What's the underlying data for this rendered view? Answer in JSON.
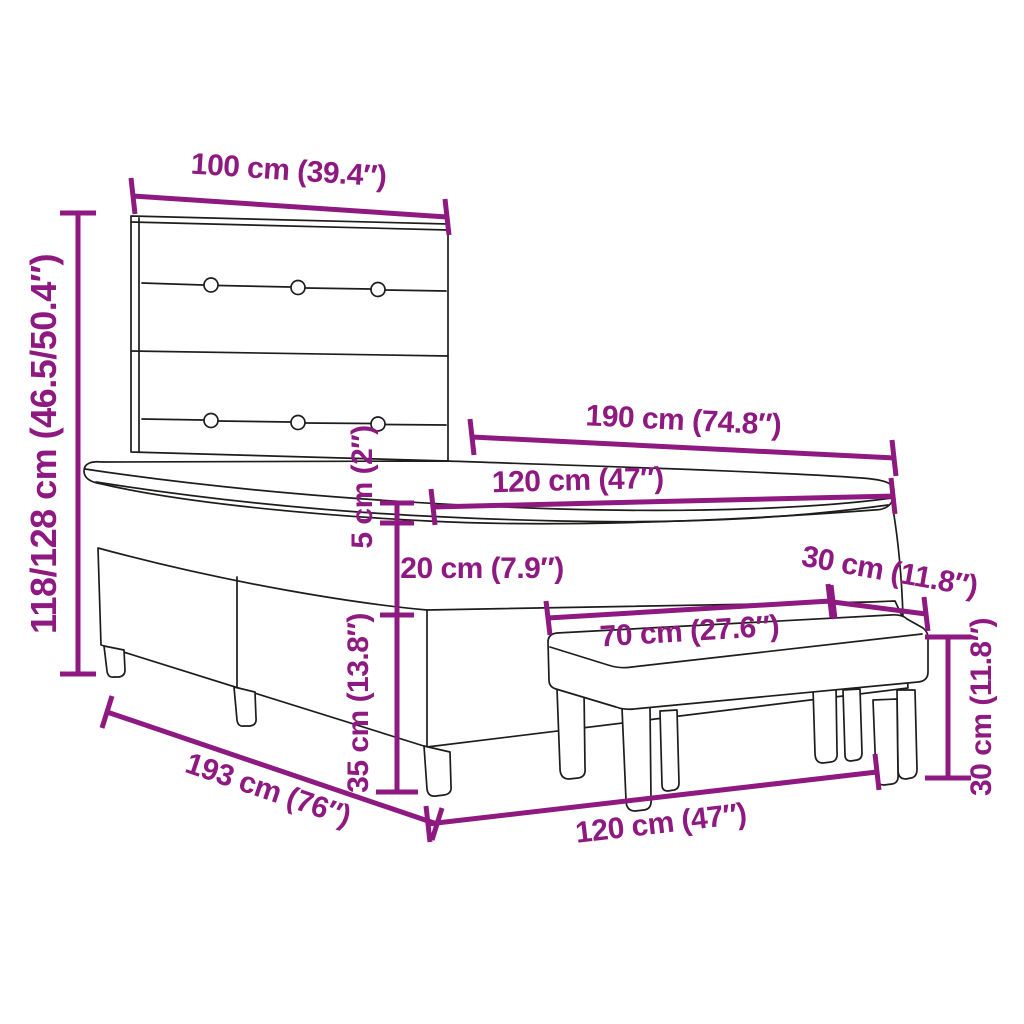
{
  "diagram": {
    "kind": "furniture-dimension-diagram",
    "subject": "box spring bed with tufted headboard, mattress and upholstered bench",
    "colors": {
      "accent": "#8E1980",
      "outline": "#1D1D1B",
      "background": "#FFFFFF"
    },
    "labels": {
      "headboard_width": "100 cm (39.4″)",
      "headboard_height": "118/128 cm (46.5/50.4″)",
      "mattress_length": "190 cm (74.8″)",
      "mattress_width": "120 cm (47″)",
      "topper_height": "5 cm (2″)",
      "base_height": "20 cm (7.9″)",
      "bench_depth": "30 cm (11.8″)",
      "bench_length": "70 cm (27.6″)",
      "leg_height": "35 cm (13.8″)",
      "bench_height": "30 cm (11.8″)",
      "bed_total_length": "193 cm (76″)",
      "bed_width": "120 cm (47″)"
    }
  }
}
